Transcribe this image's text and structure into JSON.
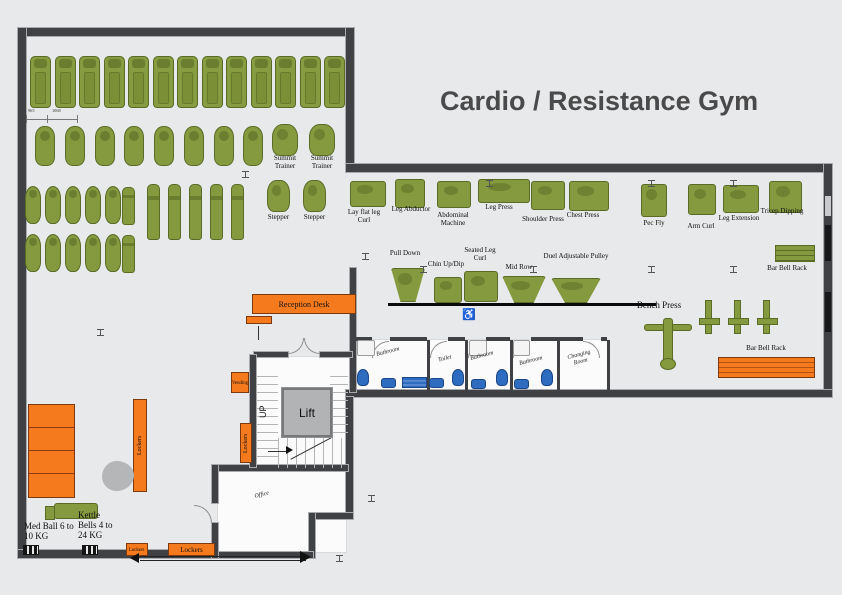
{
  "title": "Cardio / Resistance Gym",
  "dimensions": {
    "d1": "965",
    "d2": "1068"
  },
  "equipment": {
    "summit_trainer": "Summit Trainer",
    "stepper": "Stepper",
    "lay_flat_leg_curl": "Lay flat leg Curl",
    "leg_abductor": "Leg Abductor",
    "abdominal_machine": "Abdominal Machine",
    "leg_press": "Leg Press",
    "shoulder_press": "Shoulder Press",
    "chest_press": "Chest Press",
    "pec_fly": "Pec Fly",
    "arm_curl": "Arm Curl",
    "leg_extension": "Leg Extension",
    "tricep_dipping": "Tricep Dipping",
    "bar_bell_rack": "Bar Bell Rack",
    "pull_down": "Pull Down",
    "chin_up_dip": "Chin Up/Dip",
    "seated_leg_curl": "Seated Leg Curl",
    "mid_row": "Mid Row",
    "duel_adjustable_pulley": "Duel Adjustable Pulley",
    "bench_press": "Bench Press",
    "med_ball": "Med Ball 6 to 10 KG",
    "kettle_bells": "Kettle Bells 4 to 24 KG"
  },
  "rooms": {
    "bathroom": "Bathroom",
    "toilet": "Toilet",
    "changing_room": "Changing Room",
    "office": "Office"
  },
  "fixtures": {
    "reception_desk": "Reception Desk",
    "vending": "Vending",
    "lockers": "Lockers",
    "lift": "Lift",
    "up": "UP"
  },
  "icons": {
    "wheelchair": "♿"
  },
  "colors": {
    "equipment_green": "#85993e",
    "accent_orange": "#f5791d",
    "fixture_blue": "#2e6cc0",
    "wall_dark": "#3f4144",
    "title_text": "#4a4a4a"
  }
}
